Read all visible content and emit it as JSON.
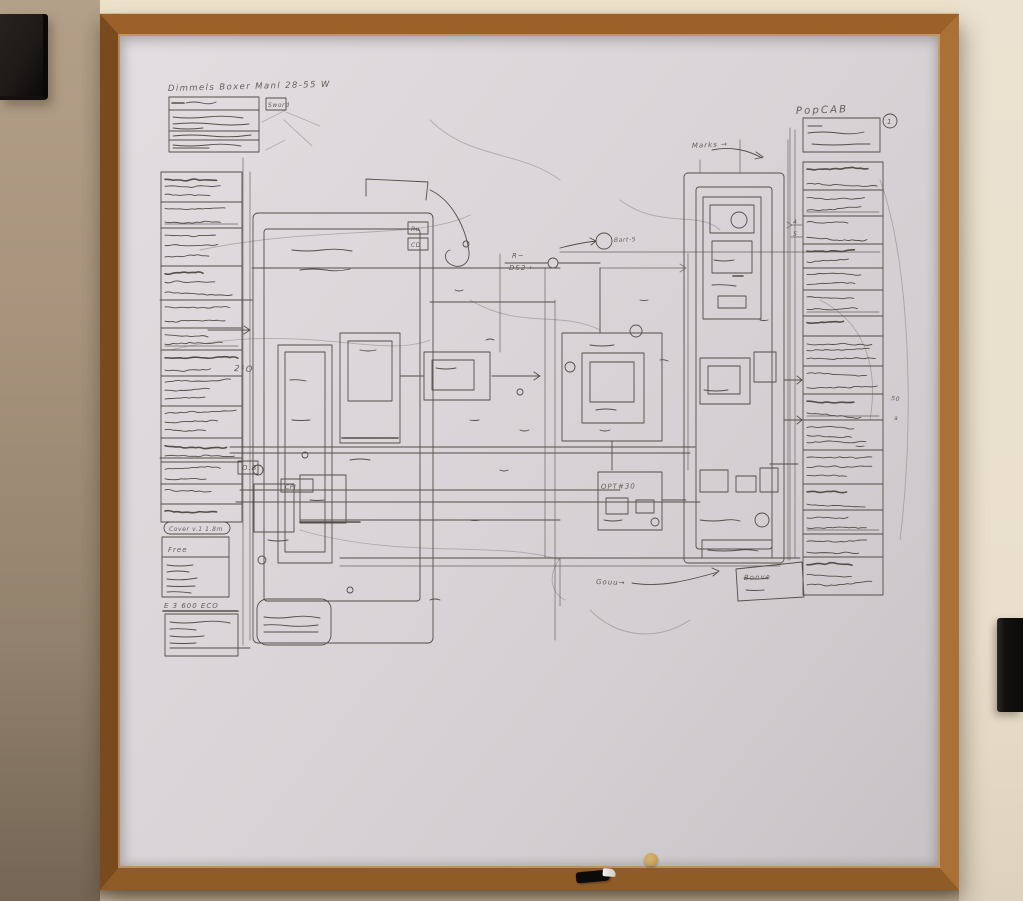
{
  "scene": {
    "description": "Photograph of a large framed whiteboard on a beige wall, covered with a dense hand-drawn engineering schematic; a black speaker hangs top-left, a black frame edge shows at right, a marker rests on the tray",
    "colors": {
      "wall_left": "#a8947d",
      "wall_cream": "#ece1cb",
      "wall_right": "#ebe2d1",
      "wall_bottom": "#c2b29a",
      "frame_top": "#9c6128",
      "frame_left": "#7a4a1f",
      "frame_right": "#aa7036",
      "frame_bottom": "#8f5c28",
      "board": "#d9d5d8",
      "speaker": "#1d1a18",
      "right_object": "#131110",
      "magnet": "#c9a25e",
      "ink": "#544e48"
    }
  },
  "sketch": {
    "title": "Dimmels Boxer Manl 28-55 W",
    "header_tag": "Sword",
    "left_legend": {
      "rows": [
        30,
        26,
        38,
        34,
        28,
        22,
        26,
        30,
        32,
        24,
        22,
        20,
        18
      ],
      "section1_header": "Cover v.1 1.8m",
      "section1_first_row": "Free",
      "section2_header": "E 3 600 ECO"
    },
    "right_legend": {
      "heading": "PopCAB",
      "badge": "1",
      "rows": [
        28,
        26,
        28,
        24,
        22,
        26,
        20,
        30,
        28,
        26,
        30,
        34,
        26,
        24,
        23,
        38
      ]
    },
    "annotations": [
      {
        "text": "Marks →",
        "x": 692,
        "y": 148,
        "size": 7,
        "rot": -3
      },
      {
        "text": "Bart-5",
        "x": 614,
        "y": 242,
        "size": 6,
        "rot": -2
      },
      {
        "text": "R~",
        "x": 512,
        "y": 258,
        "size": 7,
        "rot": 0
      },
      {
        "text": "DS2→",
        "x": 509,
        "y": 270,
        "size": 7,
        "rot": 0
      },
      {
        "text": "OPT#30",
        "x": 601,
        "y": 489,
        "size": 7,
        "rot": -1
      },
      {
        "text": "Gouu→",
        "x": 596,
        "y": 584,
        "size": 7,
        "rot": 2
      },
      {
        "text": "Bonve",
        "x": 744,
        "y": 580,
        "size": 7,
        "rot": -2
      },
      {
        "text": "O.B",
        "x": 242,
        "y": 470,
        "size": 7,
        "rot": 0
      },
      {
        "text": "2¹O",
        "x": 234,
        "y": 371,
        "size": 8,
        "rot": 3
      },
      {
        "text": "CPI",
        "x": 285,
        "y": 489,
        "size": 6,
        "rot": 0
      },
      {
        "text": "Ru",
        "x": 411,
        "y": 231,
        "size": 6,
        "rot": 0
      },
      {
        "text": "CD",
        "x": 411,
        "y": 247,
        "size": 6,
        "rot": 0
      },
      {
        "text": "4",
        "x": 793,
        "y": 224,
        "size": 6,
        "rot": 0
      },
      {
        "text": "5",
        "x": 793,
        "y": 236,
        "size": 6,
        "rot": 0
      },
      {
        "text": "50",
        "x": 891,
        "y": 400,
        "size": 6,
        "rot": 8
      },
      {
        "text": "a",
        "x": 894,
        "y": 420,
        "size": 6,
        "rot": 0
      }
    ]
  }
}
